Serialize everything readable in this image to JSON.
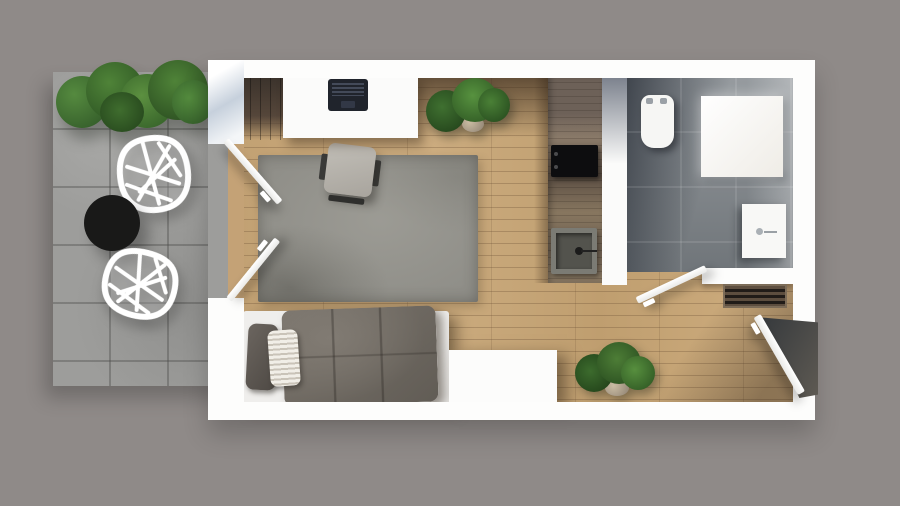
{
  "scene": {
    "label": "studio-apartment-floor-plan-top-view",
    "text_content": "none"
  },
  "palette": {
    "background": "#8f8a88",
    "wall_white": "#fdfdfc",
    "wood_floor": "#c7a678",
    "terrace_concrete": "#9d9d9b",
    "bathroom_tile": "#7f858a",
    "rug_gray": "#8f8e88",
    "counter_wood": "#6e6054",
    "plant_green": "#4f8338",
    "table_black": "#191918",
    "duvet_gray": "#6f6a63",
    "laptop_dark": "#20242c"
  },
  "rooms": {
    "terrace": {
      "label": "Terrace with concrete pavers"
    },
    "living": {
      "label": "Living room with wood floor"
    },
    "sleeping": {
      "label": "Sleeping area"
    },
    "kitchen": {
      "label": "Kitchenette counter"
    },
    "bathroom": {
      "label": "Bathroom with gray tile"
    },
    "hallway": {
      "label": "Entry hallway"
    }
  },
  "furniture": {
    "hedge": {
      "label": "Green hedge planter"
    },
    "lounge_chair_1": {
      "label": "White wireframe lounge chair (upper)"
    },
    "lounge_chair_2": {
      "label": "White wireframe lounge chair (lower)"
    },
    "coffee_table": {
      "label": "Round black coffee table"
    },
    "french_door_upper": {
      "label": "Open french door, upper leaf"
    },
    "french_door_lower": {
      "label": "Open french door, lower leaf"
    },
    "desk": {
      "label": "White desk"
    },
    "laptop": {
      "label": "Open laptop"
    },
    "desk_plants": {
      "label": "Potted plants beside desk"
    },
    "rug": {
      "label": "Gray area rug"
    },
    "office_chair": {
      "label": "Gray office chair"
    },
    "bed": {
      "label": "Bed with gray duvet"
    },
    "pillow_dark": {
      "label": "Dark gray pillow"
    },
    "pillow_knit": {
      "label": "White knit pillow"
    },
    "sideboard": {
      "label": "White sideboard"
    },
    "cooktop": {
      "label": "Black cooktop"
    },
    "kitchen_sink": {
      "label": "Kitchen sink"
    },
    "toilet": {
      "label": "Toilet"
    },
    "shower": {
      "label": "Walk-in shower"
    },
    "bathroom_sink": {
      "label": "Bathroom vanity sink"
    },
    "bathroom_door": {
      "label": "Open bathroom door"
    },
    "radiator": {
      "label": "Radiator"
    },
    "hall_plant": {
      "label": "Potted plant in hallway"
    },
    "entrance_door": {
      "label": "Open entrance door"
    }
  }
}
